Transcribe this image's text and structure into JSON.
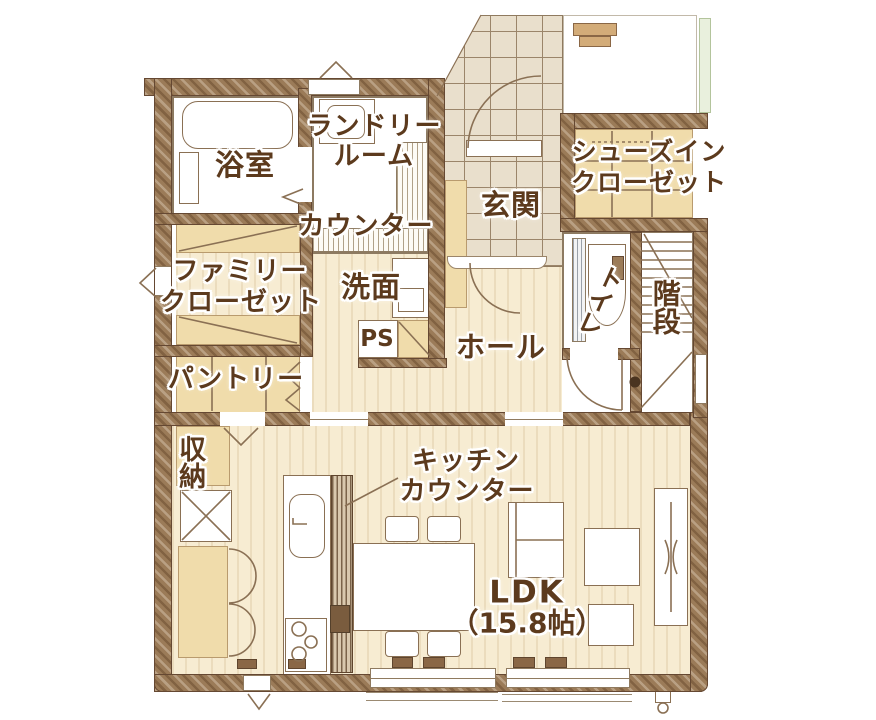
{
  "plan_type": "floor-plan",
  "colors": {
    "wall": "#9b7b58",
    "floor_wood": "#f7ecd2",
    "floor_closet": "#f0dcab",
    "floor_tile": "#e9dfcc",
    "label_text": "#5c3a1d",
    "hedge_green": "#e9f0dd"
  },
  "rooms": {
    "bathroom": {
      "label": "浴室"
    },
    "laundry": {
      "label_line1": "ランドリー",
      "label_line2": "ルーム"
    },
    "counter": {
      "label": "カウンター"
    },
    "shoes_closet": {
      "label_line1": "シューズイン",
      "label_line2": "クローゼット"
    },
    "entrance": {
      "label": "玄関"
    },
    "family_closet": {
      "label_line1": "ファミリー",
      "label_line2": "クローゼット"
    },
    "washroom": {
      "label": "洗面"
    },
    "toilet": {
      "label": "トイレ"
    },
    "stairs": {
      "label": "階段"
    },
    "pantry": {
      "label": "パントリー"
    },
    "pipe_space": {
      "label": "PS"
    },
    "hall": {
      "label": "ホール"
    },
    "storage": {
      "label": "収納"
    },
    "kitchen_counter": {
      "label_line1": "キッチン",
      "label_line2": "カウンター"
    },
    "ldk": {
      "label_line1": "LDK",
      "label_line2": "（15.8帖）",
      "size_tatami": "15.8"
    }
  }
}
